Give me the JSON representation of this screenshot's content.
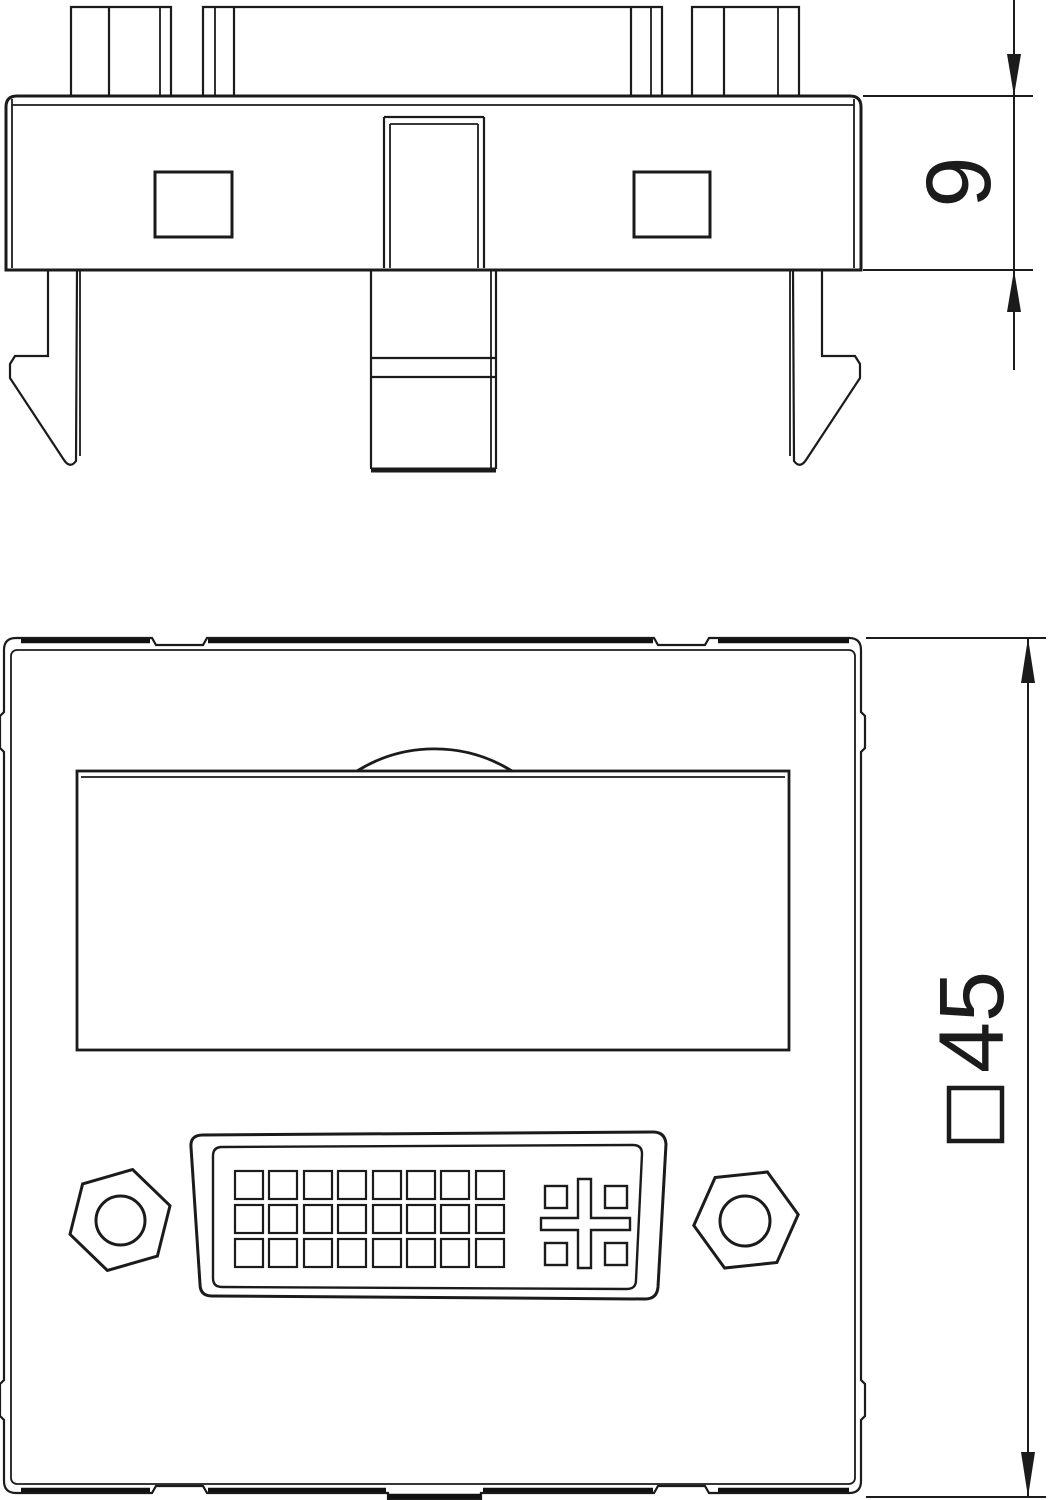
{
  "page": {
    "background": "#ffffff",
    "line_color": "#1b1b1b"
  },
  "dimensions": {
    "side_height": {
      "value": "9",
      "orientation": "rotated-90"
    },
    "front_size": {
      "symbol": "□",
      "value": "45",
      "orientation": "rotated-90"
    }
  }
}
